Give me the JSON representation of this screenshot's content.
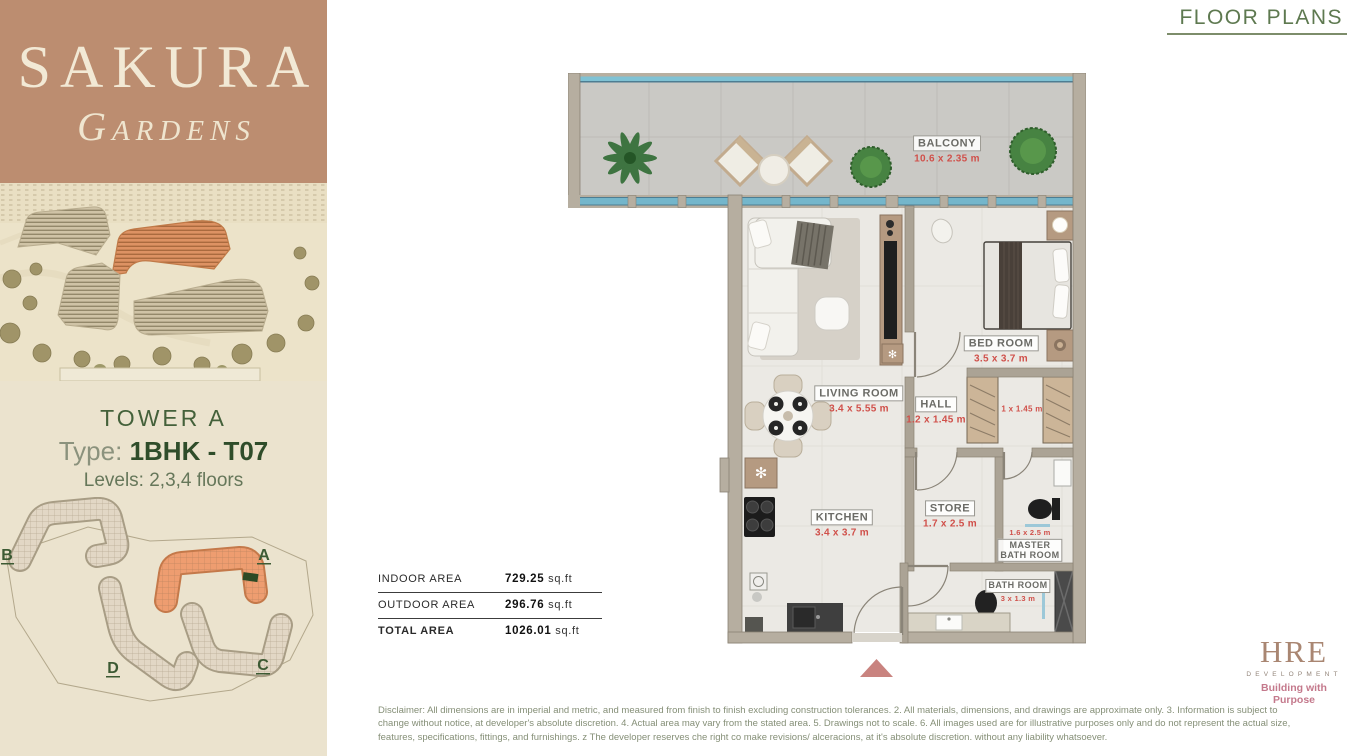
{
  "sidebar": {
    "brand": {
      "name": "SAKURA",
      "subtitle": "GARDENS"
    },
    "unit": {
      "tower": "TOWER A",
      "type_label": "Type:",
      "type_value": "1BHK - T07",
      "levels": "Levels: 2,3,4 floors"
    },
    "site_plan": {
      "buildings": [
        {
          "label": "B"
        },
        {
          "label": "A"
        },
        {
          "label": "D"
        },
        {
          "label": "C"
        }
      ]
    }
  },
  "header": {
    "title": "FLOOR PLANS"
  },
  "floor_plan": {
    "rooms": [
      {
        "name": "BALCONY",
        "dims": "10.6 x 2.35 m"
      },
      {
        "name": "LIVING ROOM",
        "dims": "3.4 x 5.55 m"
      },
      {
        "name": "HALL",
        "dims": "1.2 x 1.45 m"
      },
      {
        "name": "BED ROOM",
        "dims": "3.5 x 3.7 m"
      },
      {
        "name": "KITCHEN",
        "dims": "3.4 x 3.7 m"
      },
      {
        "name": "STORE",
        "dims": "1.7 x 2.5 m"
      },
      {
        "name": "MASTER BATH ROOM",
        "name_line1": "MASTER",
        "name_line2": "BATH ROOM",
        "dims": "1.6 x 2.5 m"
      },
      {
        "name": "BATH ROOM",
        "dims": "3 x 1.3 m"
      },
      {
        "name": "",
        "dims": "1 x 1.45 m"
      }
    ]
  },
  "areas": {
    "rows": [
      {
        "label": "INDOOR AREA",
        "value": "729.25",
        "unit": "sq.ft"
      },
      {
        "label": "OUTDOOR AREA",
        "value": "296.76",
        "unit": "sq.ft"
      },
      {
        "label": "TOTAL AREA",
        "value": "1026.01",
        "unit": "sq.ft"
      }
    ]
  },
  "developer": {
    "name": "HRE",
    "division": "DEVELOPMENT",
    "tagline": "Building with Purpose"
  },
  "disclaimer": "Disclaimer: All dimensions are in imperial and metric, and measured from finish to finish excluding construction tolerances. 2. All materials, dimensions, and drawings are approximate only. 3. Information is subject to change without notice, at developer's absolute discretion. 4. Actual area may vary from the stated area. 5. Drawings not to scale. 6. All images used are for illustrative purposes only and do not represent the actual size, features, specifications, fittings, and furnishings. z The developer reserves che right co make revisions/ alceracions, at it's absolute discretion. without any liability whatsoever.",
  "colors": {
    "accent_red": "#d0504a",
    "brand_brown": "#bc8d70",
    "green_text": "#44613a",
    "highlight_orange": "#ee9d70",
    "glass_blue": "#74b6cb",
    "entry_arrow": "#c9837f"
  }
}
